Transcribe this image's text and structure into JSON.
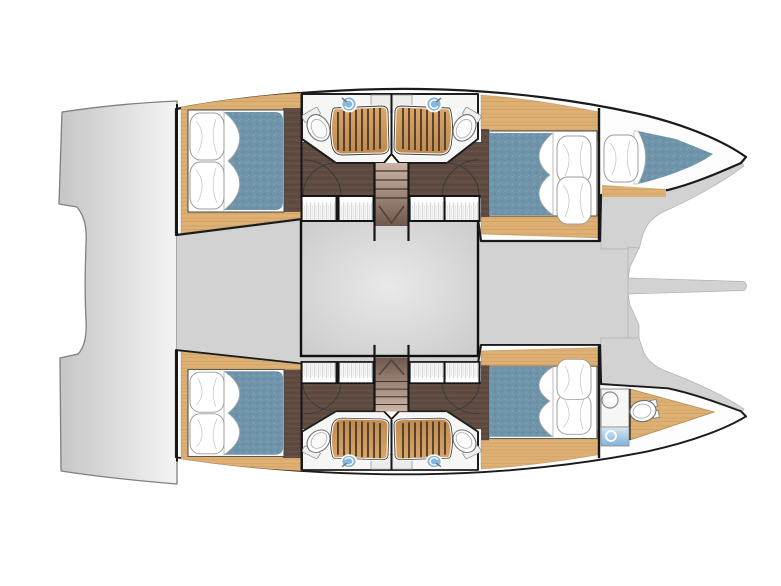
{
  "meta": {
    "title": "Catamaran interior deck plan",
    "type": "yacht-floor-plan",
    "view": "top-down"
  },
  "colors": {
    "bg": "#ffffff",
    "hull": "#fdfdfd",
    "outline": "#1b1b1b",
    "platform": "#dadada",
    "deck": "#d2d2d2",
    "salon": "#d9d9d9",
    "oak": "#deb074",
    "walnut": "#5f4b41",
    "mattress": "#6f94a9",
    "grate": "#cf9a58",
    "slat": "#40342a",
    "sink": "#85b8dc",
    "stair1": "#cdb5a6",
    "stair2": "#6e584d",
    "fixture": "#f6f6f4",
    "wall": "#161616"
  },
  "legend": {
    "rooms": [
      {
        "name": "double-cabin",
        "count": 4
      },
      {
        "name": "shower-room",
        "count": 4
      },
      {
        "name": "forepeak-berth",
        "count": 1
      },
      {
        "name": "forepeak-head",
        "count": 1
      },
      {
        "name": "salon-void",
        "count": 1
      },
      {
        "name": "transom-platform",
        "count": 1
      }
    ],
    "fixtures": [
      {
        "name": "double-bed",
        "count": 4
      },
      {
        "name": "single-berth",
        "count": 1
      },
      {
        "name": "toilet",
        "count": 5
      },
      {
        "name": "shower-grate",
        "count": 4
      },
      {
        "name": "washbasin",
        "count": 5
      },
      {
        "name": "wardrobe",
        "count": 8
      },
      {
        "name": "staircase",
        "count": 2
      },
      {
        "name": "bowsprit",
        "count": 1
      }
    ]
  }
}
